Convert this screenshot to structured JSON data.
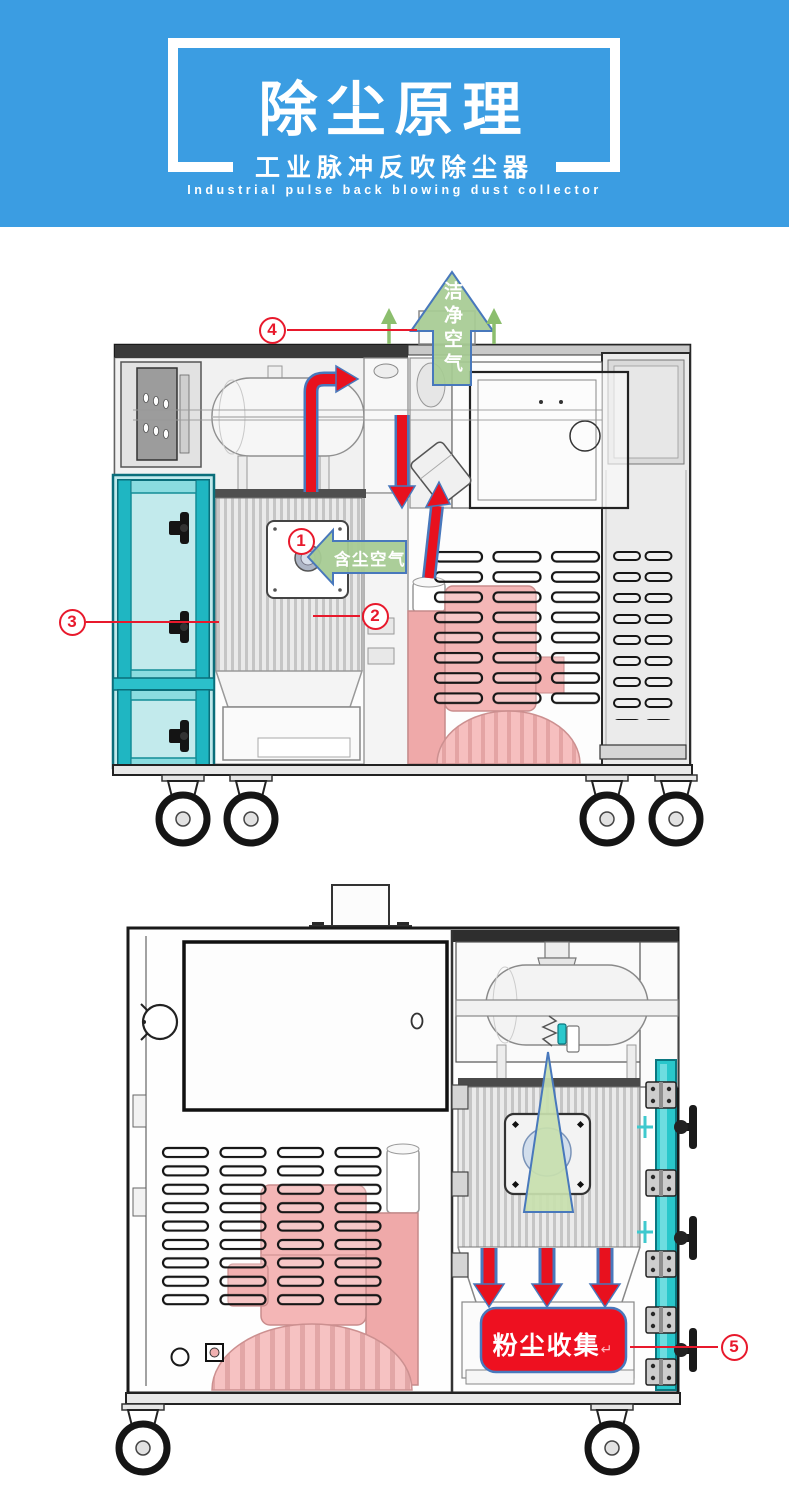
{
  "header": {
    "title": "除尘原理",
    "subtitle": "工业脉冲反吹除尘器",
    "subtitle_en": "Industrial pulse back blowing dust collector"
  },
  "labels": {
    "clean_air": "洁净空气",
    "dusty_air": "含尘空气",
    "dust_collection": "粉尘收集",
    "return_mark": "↵"
  },
  "callouts": [
    {
      "num": "1"
    },
    {
      "num": "2"
    },
    {
      "num": "3"
    },
    {
      "num": "4"
    },
    {
      "num": "5"
    }
  ],
  "colors": {
    "banner_blue": "#3B9DE2",
    "callout_red": "#E8192C",
    "flow_arrow_red": "#E8111E",
    "arrow_outline_blue": "#4878BC",
    "air_arrow_green": "#A7CB93",
    "door_teal": "#2BC0CB",
    "blower_pink": "#F4B6B6",
    "collection_box_red": "#EE1020"
  }
}
